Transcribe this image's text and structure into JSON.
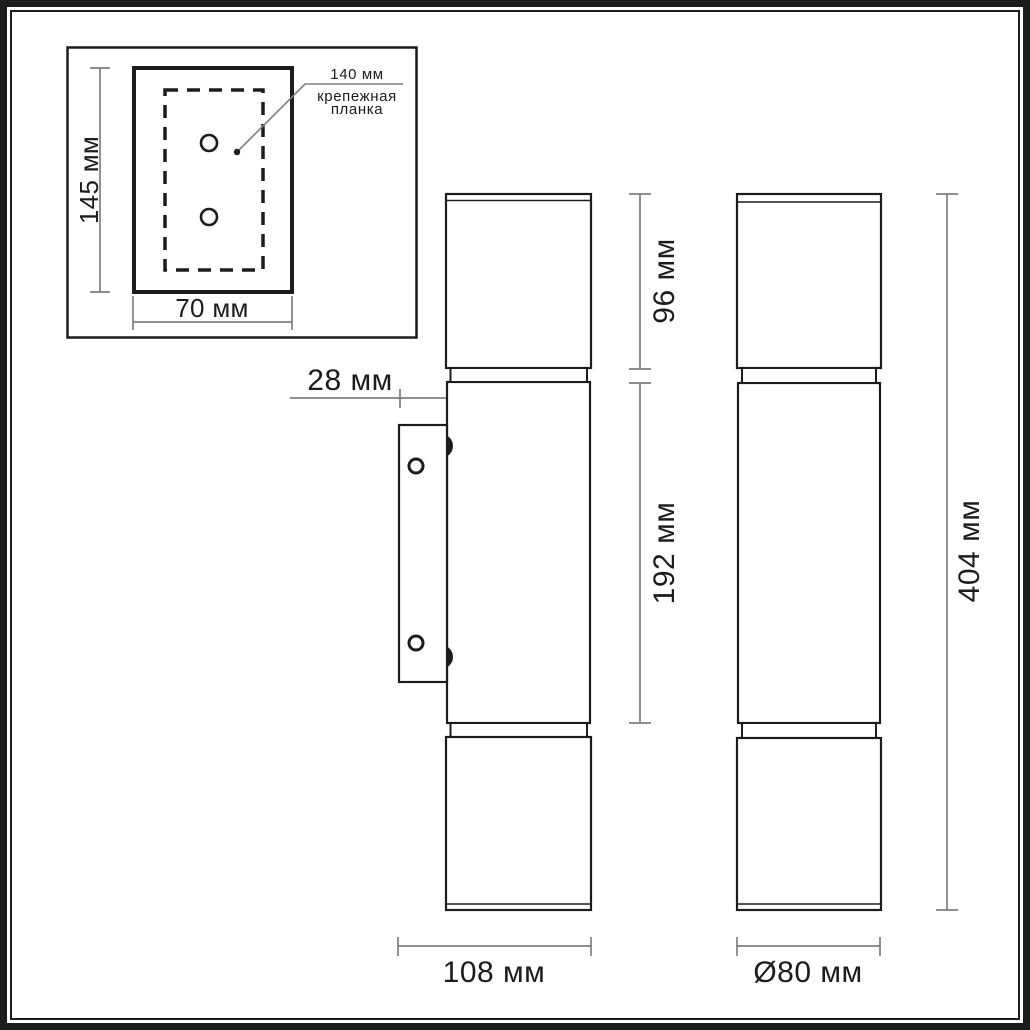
{
  "colors": {
    "line": "#1c1c1c",
    "dimension": "#7e7e7e",
    "background": "#ffffff"
  },
  "inset": {
    "height": "145 мм",
    "width": "70 мм",
    "bar_length": "140 мм",
    "bar_name_line1": "крепежная",
    "bar_name_line2": "планка"
  },
  "side_view": {
    "plate_depth": "28 мм",
    "top_section": "96 мм",
    "middle_section": "192 мм",
    "total_width": "108 мм"
  },
  "front_view": {
    "total_height": "404 мм",
    "diameter": "Ø80 мм"
  }
}
